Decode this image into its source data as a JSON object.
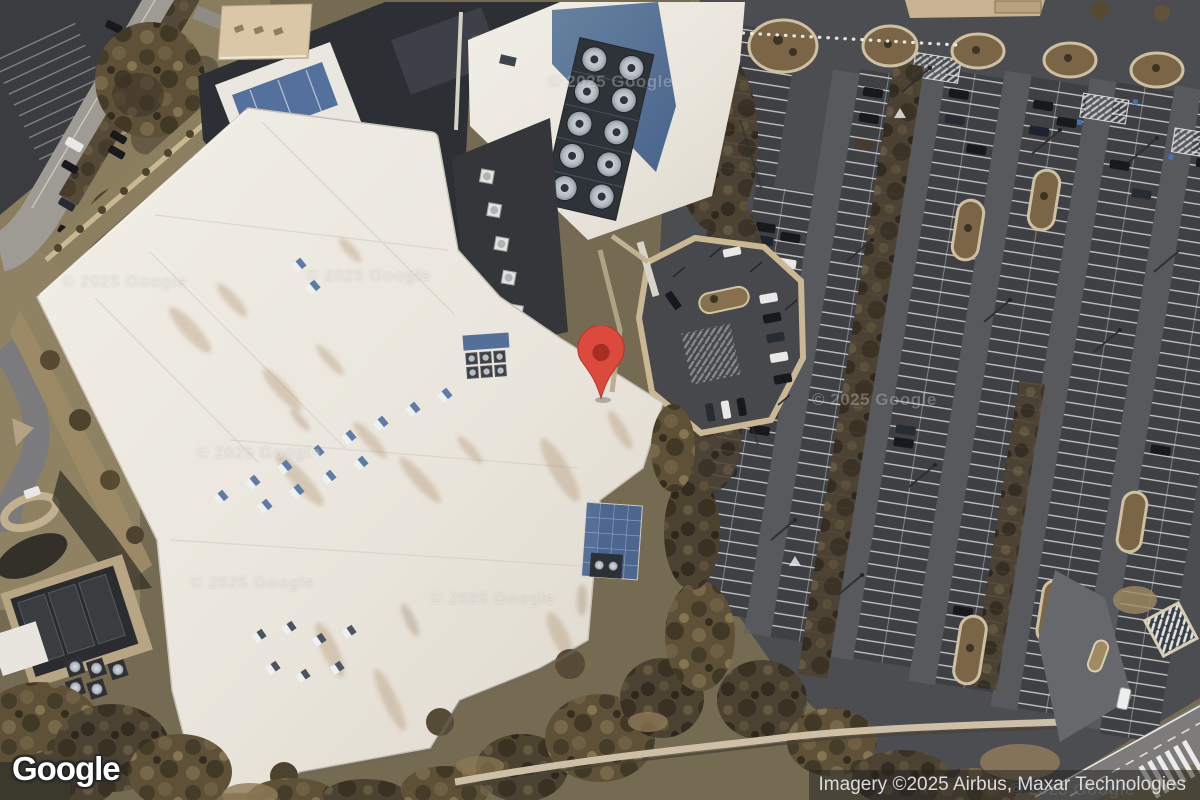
{
  "map": {
    "view_type": "satellite",
    "logo_text": "Google",
    "attribution_text": "Imagery ©2025 Airbus, Maxar Technologies",
    "watermark_text": "© 2025 Google",
    "pin": {
      "body_color": "#DB4A3D",
      "dot_color": "#A62E22"
    },
    "colors": {
      "attribution_bg": "rgba(35,35,35,0.52)",
      "attribution_fg": "#dcdcdc",
      "roof_white": "#efece4",
      "panel_blue": "#5a7299",
      "asphalt_dark": "#47484b"
    }
  }
}
